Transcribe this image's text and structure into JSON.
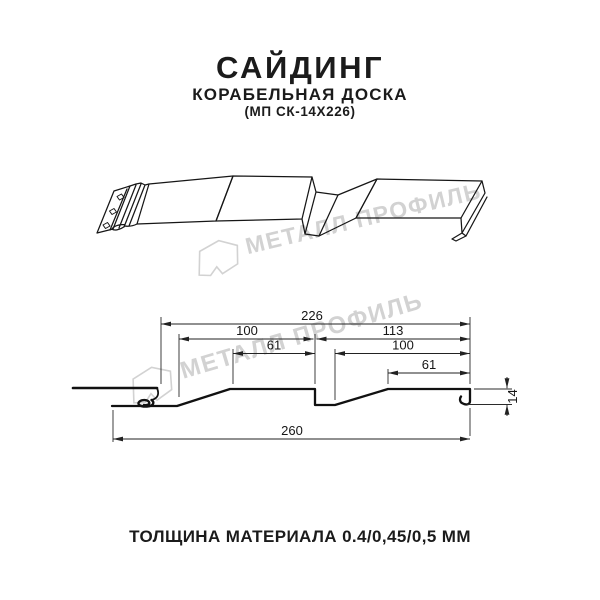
{
  "header": {
    "title": "САЙДИНГ",
    "subtitle": "КОРАБЕЛЬНАЯ ДОСКА",
    "model": "(МП СК-14Х226)"
  },
  "watermark": {
    "brand": "МЕТАЛЛ ПРОФИЛЬ"
  },
  "drawing": {
    "dimensions": {
      "overall_top": "226",
      "left_upper": "100",
      "right_upper": "113",
      "left_inner": "61",
      "right_inner": "100",
      "right_lower": "61",
      "overall_bottom": "260",
      "height": "14"
    }
  },
  "footer": {
    "thickness_note": "ТОЛЩИНА МАТЕРИАЛА 0.4/0,45/0,5 ММ"
  },
  "colors": {
    "line": "#161616",
    "watermark": "#d2d2d2",
    "background": "#ffffff"
  }
}
